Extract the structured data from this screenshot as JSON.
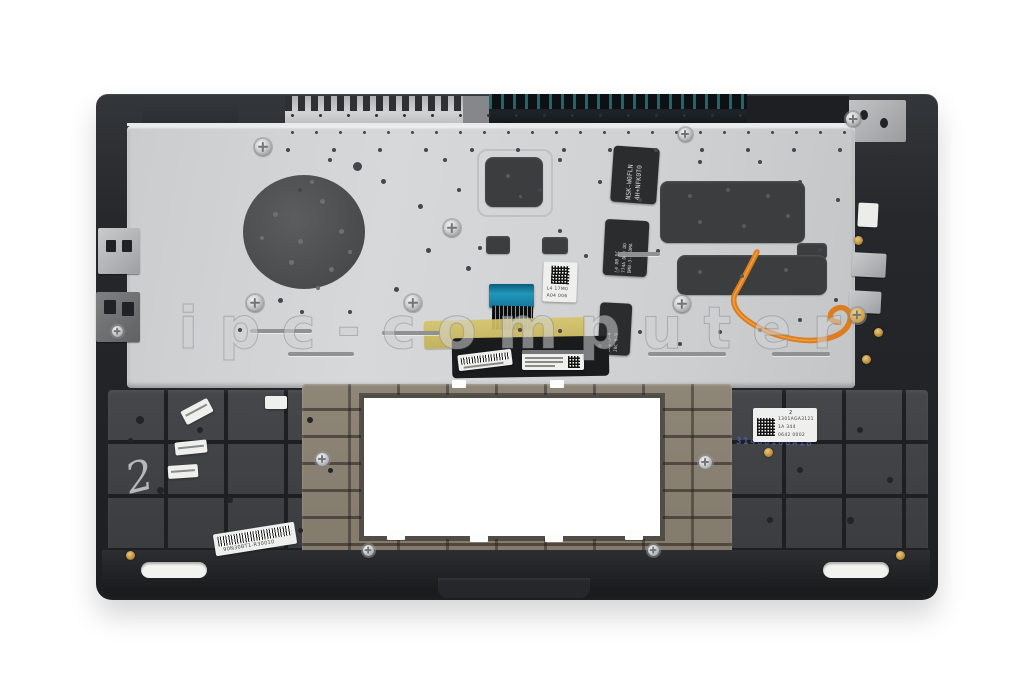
{
  "photo": {
    "watermark": "ipc-computer"
  },
  "labels": {
    "kb_label_1": {
      "line1": "NSK-W0FLN",
      "line2": "4H+NFK0T0"
    },
    "kb_label_2": {
      "line1": "L4 DB DC",
      "line2": "774A DDB DD",
      "line3": "DMB-3-1 DMA"
    },
    "kb_label_3": {
      "line1": "DMB-3-4",
      "line2": "J8C 6-9"
    },
    "center_sticker": {
      "line1": "L4 17M0",
      "line2": "A04 006"
    },
    "right_info_label": {
      "line1": "2",
      "line2": "1301AGA3121",
      "line3": "1A  344",
      "line4": "0642  0002"
    },
    "embossed_marking": "31488188A1B",
    "bottom_barcode_sticker": "90N30BT1-R30010",
    "handwritten_mark": "2"
  },
  "colors": {
    "backplate_silver": "#cfd0d2",
    "chassis_dark": "#25272a",
    "touchpad_frame_khaki": "#8b8274",
    "kapton_tape_yellow": "#d2bd69",
    "ribbon_cable_blue": "#1b84a6",
    "flex_cable_orange": "#e0801f"
  }
}
